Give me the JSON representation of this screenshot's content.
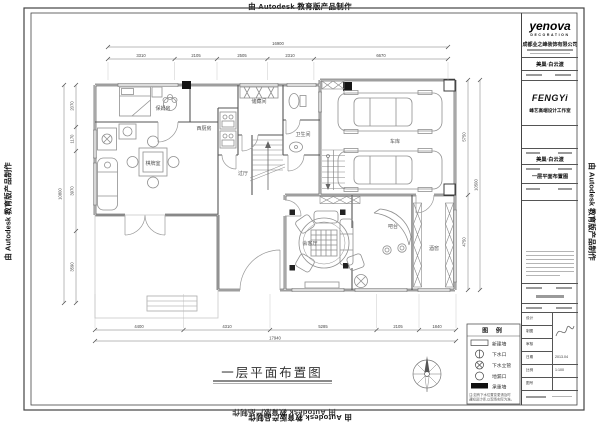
{
  "watermark": {
    "text": "由 Autodesk 教育版产品制作"
  },
  "plan": {
    "title": "一层平面布置图",
    "rooms": {
      "nanny": "保姆房",
      "kitchen_w": "西厨房",
      "storage": "储藏间",
      "bath": "卫生间",
      "garage": "车库",
      "chess": "棋牌室",
      "hall": "过厅",
      "reception": "会客厅",
      "bar": "吧台",
      "cellar": "酒窖"
    },
    "dims": {
      "top": {
        "segments": [
          "3310",
          "2105",
          "2505",
          "2310",
          "6670"
        ],
        "total": "16900"
      },
      "bottom": {
        "segments": [
          "4400",
          "4310",
          "5285",
          "2105",
          "1840"
        ],
        "total": "17940"
      },
      "left": {
        "segments": [
          "2070",
          "1170",
          "3970",
          "3590"
        ],
        "total": "10800"
      },
      "right": {
        "segments": [
          "5750",
          "4750"
        ],
        "total": "10500"
      }
    },
    "legend": {
      "header": "图 例",
      "items": [
        {
          "label": "新建墙"
        },
        {
          "label": "下水口"
        },
        {
          "label": "下水立管"
        },
        {
          "label": "地漏口"
        },
        {
          "label": "承重墙"
        }
      ],
      "notes": [
        "注:如有下水位置变更请及时",
        "通知设计师,以现场实际为准。"
      ]
    }
  },
  "title_block": {
    "brand": {
      "name": "yenova",
      "sub": "DECORATION"
    },
    "company": "成都业之峰装饰有限公司",
    "project": "美巢·白云渡",
    "studio": {
      "logo": "FENGYi",
      "name": "峰艺高端设计工作室"
    },
    "drawing": "一层平面布置图",
    "table": {
      "rows": [
        "设计",
        "制图",
        "审核",
        "日期",
        "比例",
        "图号"
      ],
      "date": "2013.04",
      "scale": "1:100"
    }
  }
}
